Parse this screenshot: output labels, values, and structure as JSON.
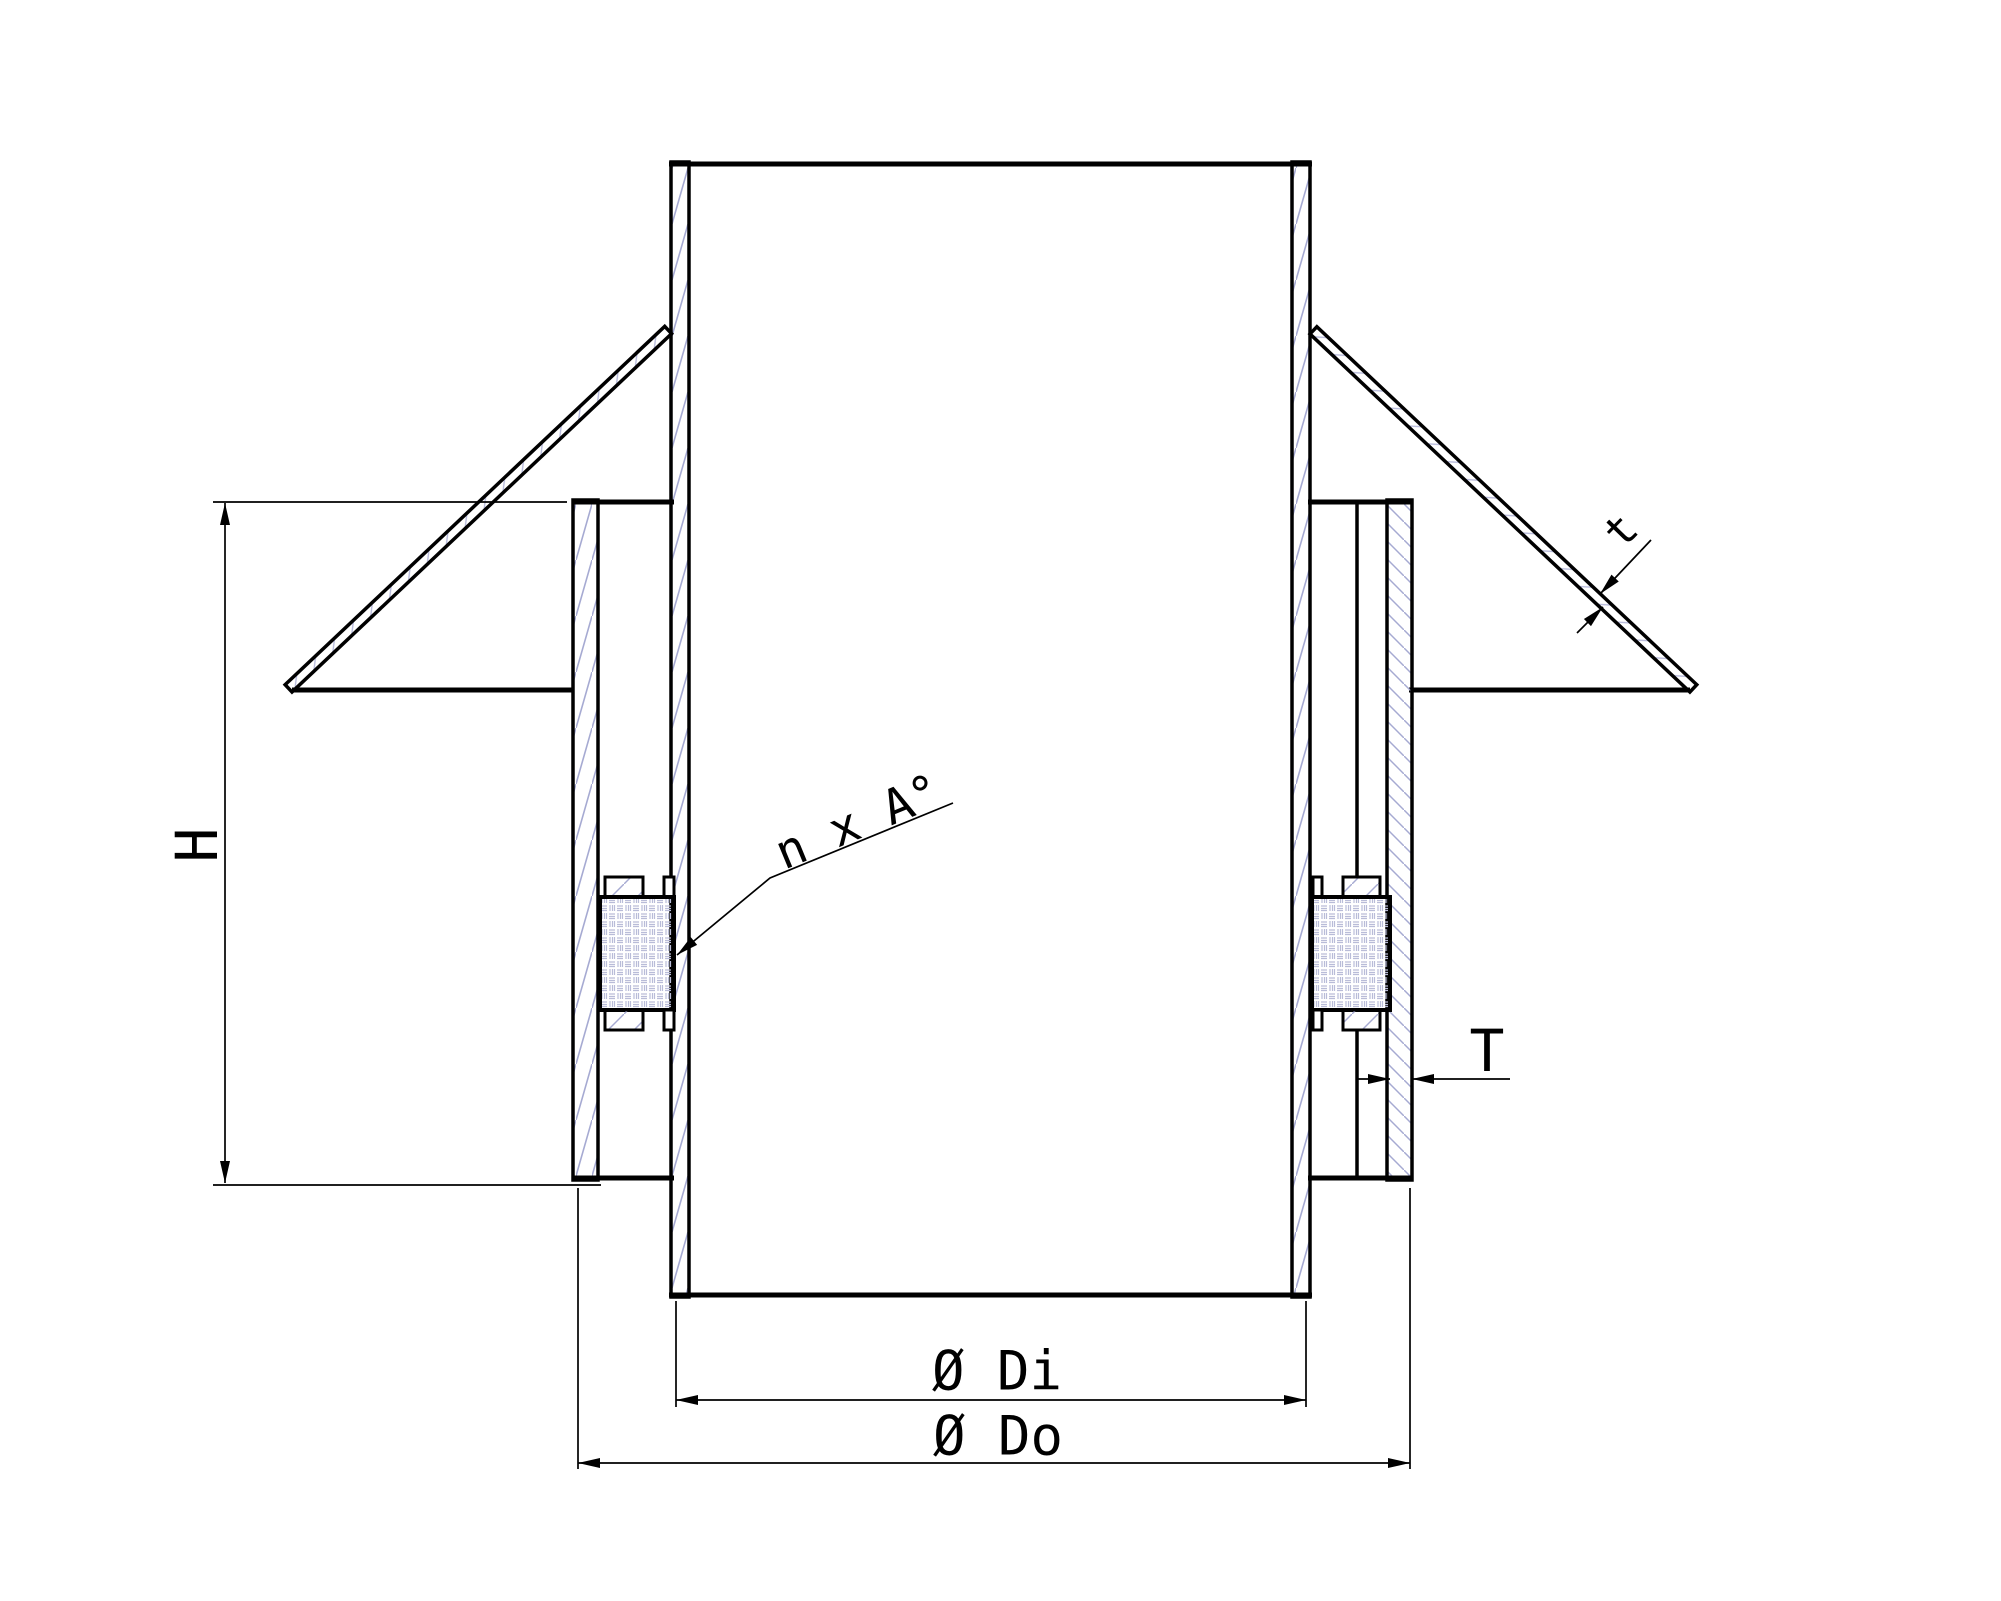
{
  "drawing": {
    "kind": "technical-section-drawing",
    "subject": "pipe with roof flashing cone and storm collar, sectional view",
    "labels": {
      "height": "H",
      "flashing_thickness": "t",
      "collar_thickness": "T",
      "angle_note": "n x A°",
      "inner_diameter": "Ø Di",
      "outer_diameter": "Ø Do"
    },
    "colors": {
      "line": "#000000",
      "hatch": "#a6aad2",
      "background": "#ffffff"
    }
  }
}
